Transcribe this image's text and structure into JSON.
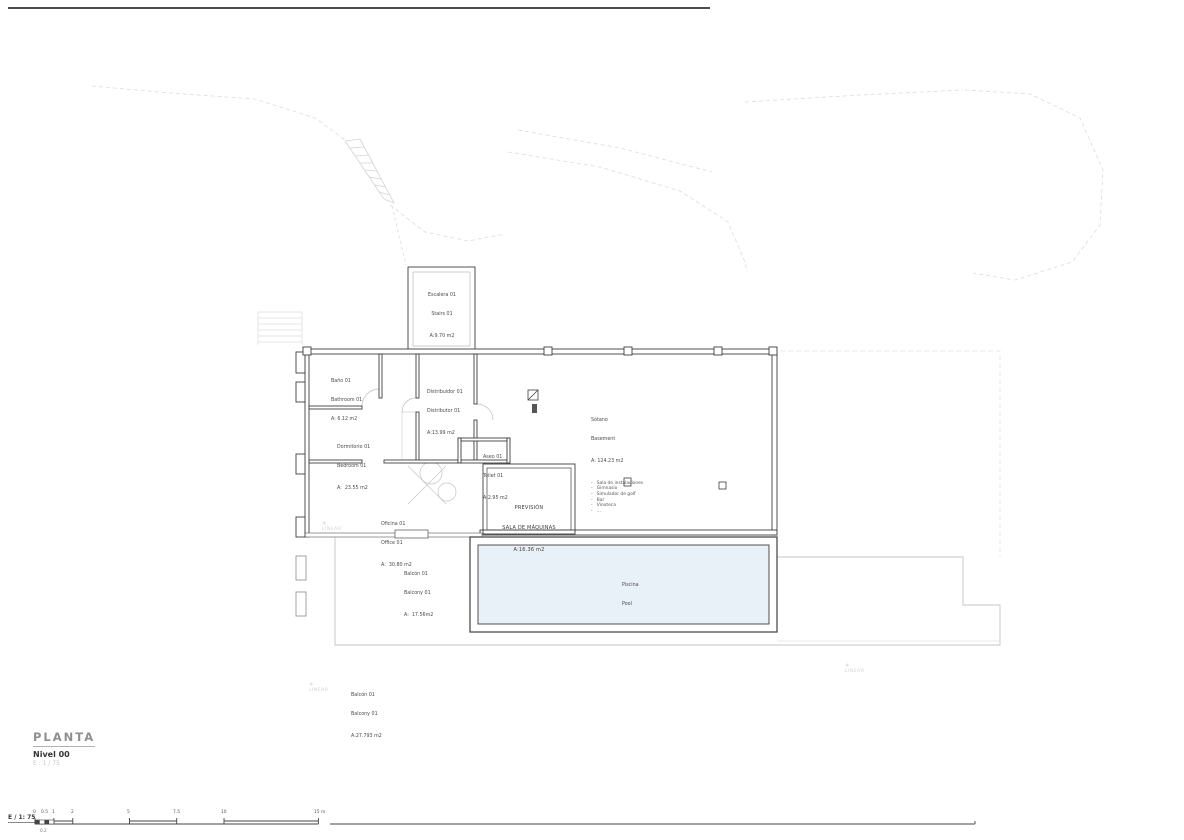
{
  "colors": {
    "pool_water": "#e9f1f8",
    "wall_dark": "#3f3f3f"
  },
  "titleblock": {
    "title": "PLANTA",
    "level": "Nivel 00",
    "scale": "E : 1 / 75"
  },
  "scalebar": {
    "label": "E / 1: 75",
    "ticks": [
      "0",
      "0.5",
      "1",
      "2",
      "5",
      "7.5",
      "10",
      "15 m"
    ],
    "sub_tick": "0.2"
  },
  "watermark": {
    "icon": "✳",
    "text": "LINEAR"
  },
  "rooms": {
    "stairs": {
      "name_es": "Escalera 01",
      "name_en": "Stairs 01",
      "area": "A:9.70 m2"
    },
    "bathroom": {
      "name_es": "Baño 01",
      "name_en": "Bathroom 01",
      "area": "A: 6.12 m2"
    },
    "hall": {
      "name_es": "Distribuidor 01",
      "name_en": "Distributor 01",
      "area": "A:13.99 m2"
    },
    "bedroom": {
      "name_es": "Dormitorio 01",
      "name_en": "Bedroom 01",
      "area": "A:  23.55 m2"
    },
    "toilet": {
      "name_es": "Aseo 01",
      "name_en": "Toilet 01",
      "area": "A:2.95 m2"
    },
    "basement": {
      "name_es": "Sótano",
      "name_en": "Basement",
      "area": "A: 124.23 m2",
      "items": [
        "-   Sala de instalaciones",
        "-   Gimnasio",
        "-   Simulador de golf",
        "-   Bar",
        "-   Vinoteca",
        "-   ..."
      ]
    },
    "machine_room": {
      "line1": "PREVISIÓN",
      "line2": "SALA DE MÁQUINAS",
      "area": "A:16.36 m2"
    },
    "office": {
      "name_es": "Oficina 01",
      "name_en": "Office 01",
      "area": "A:  30.80 m2"
    },
    "balcony_upper": {
      "name_es": "Balcón 01",
      "name_en": "Balcony 01",
      "area": "A:  17.56m2"
    },
    "pool": {
      "name_es": "Piscina",
      "name_en": "Pool"
    },
    "balcony_lower": {
      "name_es": "Balcón 01",
      "name_en": "Balcony 01",
      "area": "A:27.793 m2"
    }
  }
}
